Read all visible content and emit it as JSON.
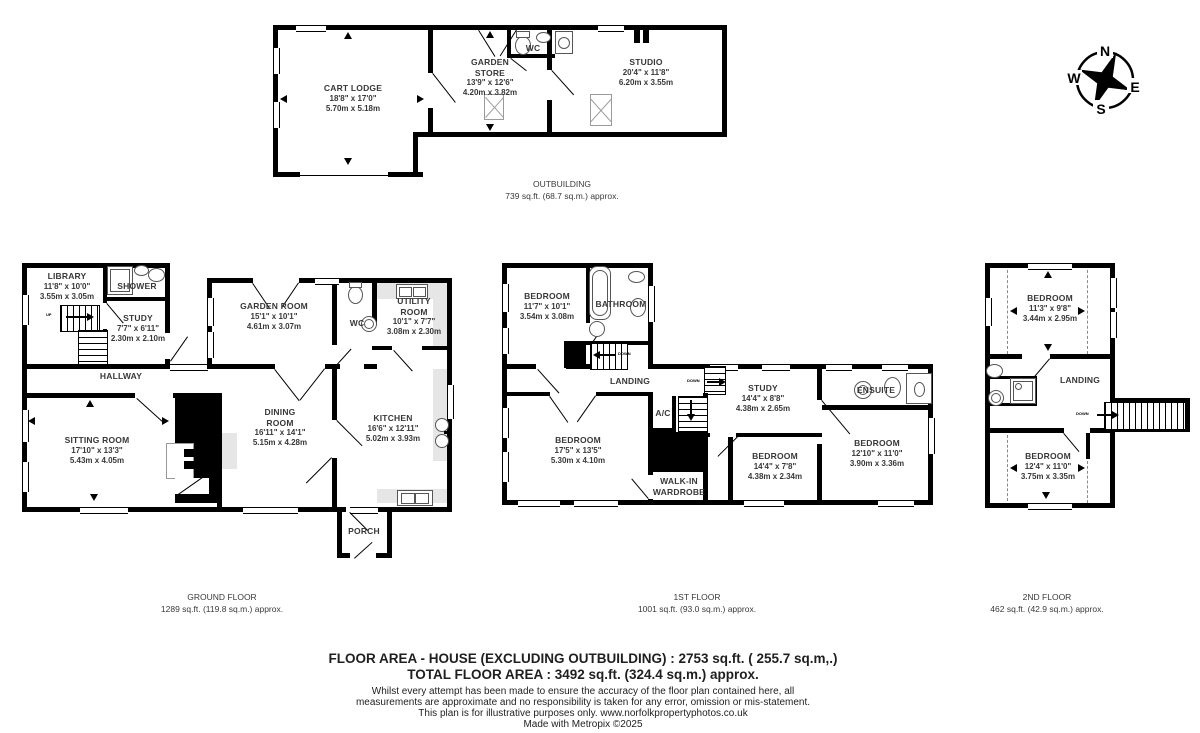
{
  "colors": {
    "wall": "#000000",
    "label_text": "#383838",
    "counter": "#e6e6e6"
  },
  "compass": {
    "north": "N",
    "east": "E",
    "south": "S",
    "west": "W"
  },
  "stair_labels": {
    "up": "UP",
    "down": "DOWN"
  },
  "outbuilding": {
    "caption": {
      "title": "OUTBUILDING",
      "area": "739 sq.ft. (68.7 sq.m.) approx."
    },
    "rooms": {
      "cart_lodge": {
        "name": "CART LODGE",
        "ft": "18'8\" x 17'0\"",
        "m": "5.70m x 5.18m"
      },
      "garden_store": {
        "name": "GARDEN STORE",
        "ft": "13'9\" x 12'6\"",
        "m": "4.20m x 3.82m"
      },
      "wc": {
        "name": "WC"
      },
      "studio": {
        "name": "STUDIO",
        "ft": "20'4\" x 11'8\"",
        "m": "6.20m x 3.55m"
      }
    }
  },
  "ground_floor": {
    "caption": {
      "title": "GROUND FLOOR",
      "area": "1289 sq.ft. (119.8 sq.m.) approx."
    },
    "rooms": {
      "library": {
        "name": "LIBRARY",
        "ft": "11'8\" x 10'0\"",
        "m": "3.55m x 3.05m"
      },
      "shower": {
        "name": "SHOWER"
      },
      "study": {
        "name": "STUDY",
        "ft": "7'7\" x 6'11\"",
        "m": "2.30m x 2.10m"
      },
      "hallway": {
        "name": "HALLWAY"
      },
      "sitting_room": {
        "name": "SITTING ROOM",
        "ft": "17'10\" x 13'3\"",
        "m": "5.43m x 4.05m"
      },
      "garden_room": {
        "name": "GARDEN ROOM",
        "ft": "15'1\" x 10'1\"",
        "m": "4.61m x 3.07m"
      },
      "wc": {
        "name": "WC"
      },
      "utility_room": {
        "name": "UTILITY ROOM",
        "ft": "10'1\" x 7'7\"",
        "m": "3.08m x 2.30m"
      },
      "dining_room": {
        "name": "DINING ROOM",
        "ft": "16'11\" x 14'1\"",
        "m": "5.15m x 4.28m"
      },
      "kitchen": {
        "name": "KITCHEN",
        "ft": "16'6\" x 12'11\"",
        "m": "5.02m x 3.93m"
      },
      "porch": {
        "name": "PORCH"
      }
    }
  },
  "first_floor": {
    "caption": {
      "title": "1ST FLOOR",
      "area": "1001 sq.ft. (93.0 sq.m.) approx."
    },
    "rooms": {
      "bedroom1": {
        "name": "BEDROOM",
        "ft": "11'7\" x 10'1\"",
        "m": "3.54m x 3.08m"
      },
      "bathroom": {
        "name": "BATHROOM"
      },
      "landing": {
        "name": "LANDING"
      },
      "ac": {
        "name": "A/C"
      },
      "bedroom2": {
        "name": "BEDROOM",
        "ft": "17'5\" x 13'5\"",
        "m": "5.30m x 4.10m"
      },
      "walk_in_wardrobe": {
        "name": "WALK-IN WARDROBE"
      },
      "study": {
        "name": "STUDY",
        "ft": "14'4\" x 8'8\"",
        "m": "4.38m x 2.65m"
      },
      "bedroom3": {
        "name": "BEDROOM",
        "ft": "14'4\" x 7'8\"",
        "m": "4.38m x 2.34m"
      },
      "ensuite": {
        "name": "ENSUITE"
      },
      "bedroom4": {
        "name": "BEDROOM",
        "ft": "12'10\" x 11'0\"",
        "m": "3.90m x 3.36m"
      }
    }
  },
  "second_floor": {
    "caption": {
      "title": "2ND FLOOR",
      "area": "462 sq.ft. (42.9 sq.m.) approx."
    },
    "rooms": {
      "bedroom_top": {
        "name": "BEDROOM",
        "ft": "11'3\" x 9'8\"",
        "m": "3.44m x 2.95m"
      },
      "landing": {
        "name": "LANDING"
      },
      "bedroom_bottom": {
        "name": "BEDROOM",
        "ft": "12'4\" x 11'0\"",
        "m": "3.75m x 3.35m"
      }
    }
  },
  "summary": {
    "house_area": "FLOOR AREA - HOUSE (EXCLUDING OUTBUILDING) : 2753 sq.ft. ( 255.7 sq.m,.)",
    "total_area": "TOTAL FLOOR AREA : 3492 sq.ft. (324.4 sq.m.) approx.",
    "disclaimer_line1": "Whilst every attempt has been made to ensure the accuracy of the floor plan contained here, all",
    "disclaimer_line2": "measurements are approximate and no responsibility is taken for any error, omission or mis-statement.",
    "disclaimer_line3": "This plan is for illustrative purposes only. www.norfolkpropertyphotos.co.uk",
    "disclaimer_line4": "Made with Metropix ©2025"
  }
}
